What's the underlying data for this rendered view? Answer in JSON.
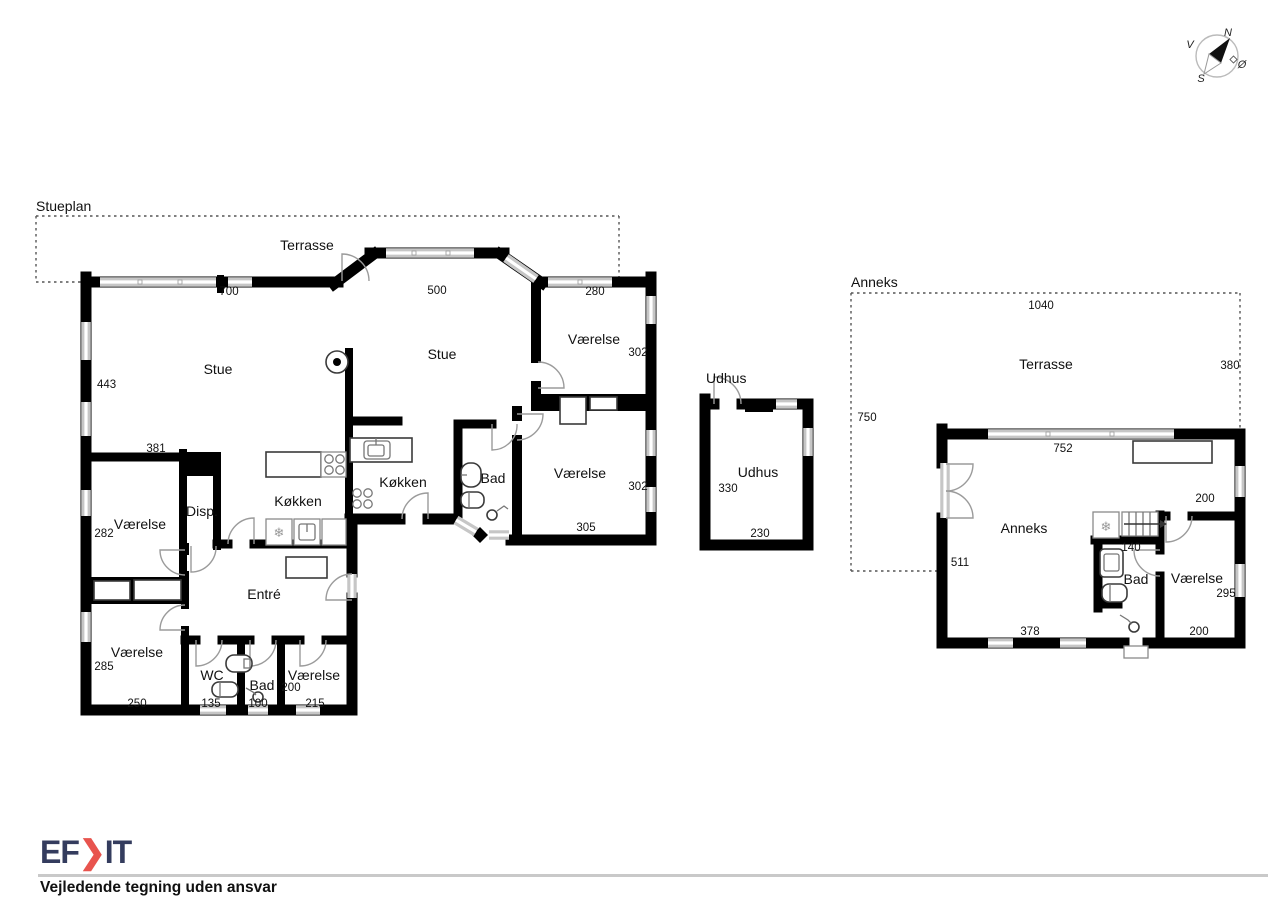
{
  "colors": {
    "wall": "#000000",
    "window": "#c6c6c6",
    "logo_navy": "#343c5e",
    "logo_red": "#e8544e",
    "rule_gray": "#c9c9c9"
  },
  "compass": {
    "north": "N",
    "west": "V",
    "south": "S",
    "east": "Ø"
  },
  "stueplan": {
    "title": "Stueplan",
    "terrace": {
      "label": "Terrasse",
      "width": "700"
    },
    "stue_left": {
      "label": "Stue"
    },
    "stue_right": {
      "label": "Stue",
      "top_width": "500"
    },
    "left_wall_height": "443",
    "vaerelse_top_right": {
      "label": "Værelse",
      "top_width": "280",
      "right_height": "302"
    },
    "vaerelse_mid_right": {
      "label": "Værelse",
      "right_height": "302",
      "bottom_width": "305"
    },
    "bad_center": {
      "label": "Bad"
    },
    "koekken_left": {
      "label": "Køkken"
    },
    "koekken_right": {
      "label": "Køkken"
    },
    "disp": {
      "label": "Disp."
    },
    "vaerelse_left": {
      "label": "Værelse",
      "top_width": "381",
      "left_height": "282"
    },
    "entre": {
      "label": "Entré"
    },
    "vaerelse_bottom_left": {
      "label": "Værelse",
      "left_height": "285",
      "bottom_width": "250"
    },
    "wc": {
      "label": "WC",
      "bottom_width": "135"
    },
    "bad_bottom": {
      "label": "Bad",
      "bottom_width": "100"
    },
    "vaerelse_bottom_mid": {
      "label": "Værelse",
      "left_height": "200",
      "bottom_width": "215"
    }
  },
  "udhus": {
    "title": "Udhus",
    "room_label": "Udhus",
    "left_height": "330",
    "bottom_width": "230"
  },
  "anneks": {
    "title": "Anneks",
    "terrace": {
      "label": "Terrasse",
      "top_width": "1040",
      "right_height": "380",
      "left_height": "750"
    },
    "main_room": {
      "label": "Anneks",
      "top_width": "752",
      "left_height": "511",
      "bottom_width": "378",
      "wardrobe_depth": "200",
      "stair_width": "140"
    },
    "bad": {
      "label": "Bad"
    },
    "vaerelse": {
      "label": "Værelse",
      "right_height": "295",
      "bottom_width": "200"
    }
  },
  "footer": {
    "logo_prefix": "EF",
    "logo_suffix": "IT",
    "disclaimer": "Vejledende tegning uden ansvar"
  }
}
